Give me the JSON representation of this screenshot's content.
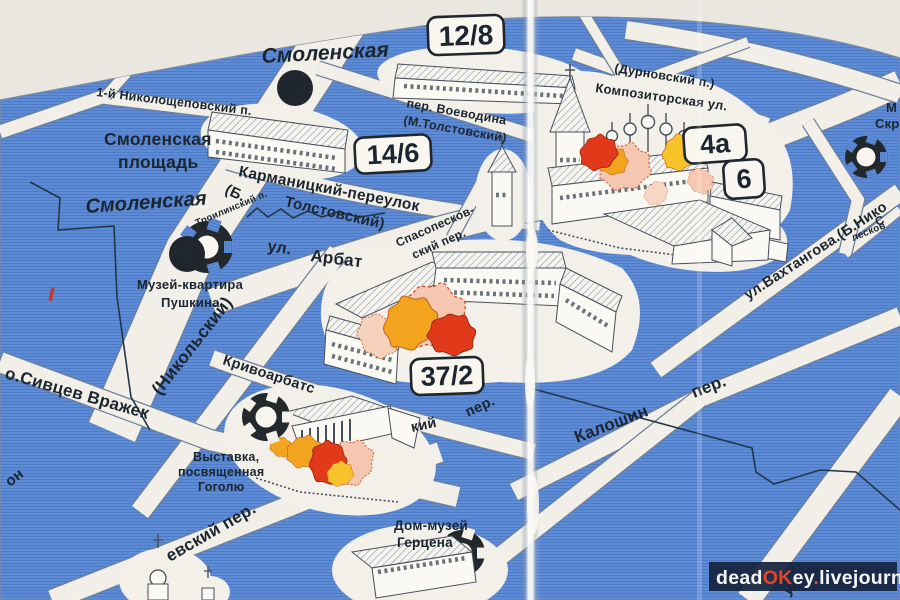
{
  "metro": {
    "letter": "М",
    "top_label": "Смоленская",
    "bottom_label": "Смоленская"
  },
  "badges": {
    "voevodina_house": "12/8",
    "smolenskaya_house": "14/6",
    "arbat_house": "37/2",
    "church_house_a": "4а",
    "church_house_b": "6"
  },
  "labels": {
    "square_line1": "Смоленская",
    "square_line2": "площадь",
    "nikoloshchepovsky": "1-й Николощеповский п.",
    "karmanitsky": "Карманицкий-переулок",
    "karmanitsky_old_a": "(Б.",
    "karmanitsky_old_b": "Толстовский)",
    "troilinsky": "Троилинский п.",
    "voevodina": "пер. Воеводина",
    "voevodina_old": "(М.Толстовский)",
    "arbat_prefix": "ул.",
    "arbat": "Арбат",
    "spasopeskovsky_a": "Спасопесков-",
    "spasopeskovsky_b": "ский пер.",
    "durnovsky": "(Дурновский п.)",
    "kompozitorskaya": "Композиторская ул.",
    "nikolsky": "(Никольский)",
    "sivtsev": "о.Сивцев Вражек",
    "on_fragment": "он",
    "krivoarbatsky_a": "Кривоарбатс",
    "krivoarbatsky_b": "кий",
    "krivoarbatsky_c": "пер.",
    "evsky": "евский пер.",
    "vakhtangova": "ул.Вахтангова.(Б.Нико",
    "peskovsky_fragment": "лесков",
    "s_fragment": "С",
    "kaloshin": "Калошин",
    "kaloshin_suffix": "пер.",
    "pereulok_fragment": "улок",
    "skryabin_m": "М",
    "skryabin_skr": "Скр"
  },
  "pois": {
    "pushkin_a": "Музей-квартира",
    "pushkin_b": "Пушкина",
    "gogol_a": "Выставка,",
    "gogol_b": "посвященная",
    "gogol_c": "Гоголю",
    "herzen_a": "Дом-музей",
    "herzen_b": "Герцена"
  },
  "watermark": {
    "parts": [
      {
        "t": "dead",
        "c": "#f5f5f5"
      },
      {
        "t": "OK",
        "c": "#e2452a"
      },
      {
        "t": "ey",
        "c": "#f5f5f5"
      },
      {
        "t": ".",
        "c": "#e2452a"
      },
      {
        "t": "livejournal",
        "c": "#f5f5f5"
      },
      {
        "t": ".",
        "c": "#e2452a"
      },
      {
        "t": "com",
        "c": "#f5f5f5"
      }
    ]
  },
  "colors": {
    "map_blue": "#5e8bd6",
    "street": "#f1efe7",
    "ink": "#1c2630",
    "splat_red": "#e03a1a",
    "splat_orange": "#f3a41e",
    "splat_pink": "#f5c7b0",
    "watermark_bg": "#16233e"
  }
}
